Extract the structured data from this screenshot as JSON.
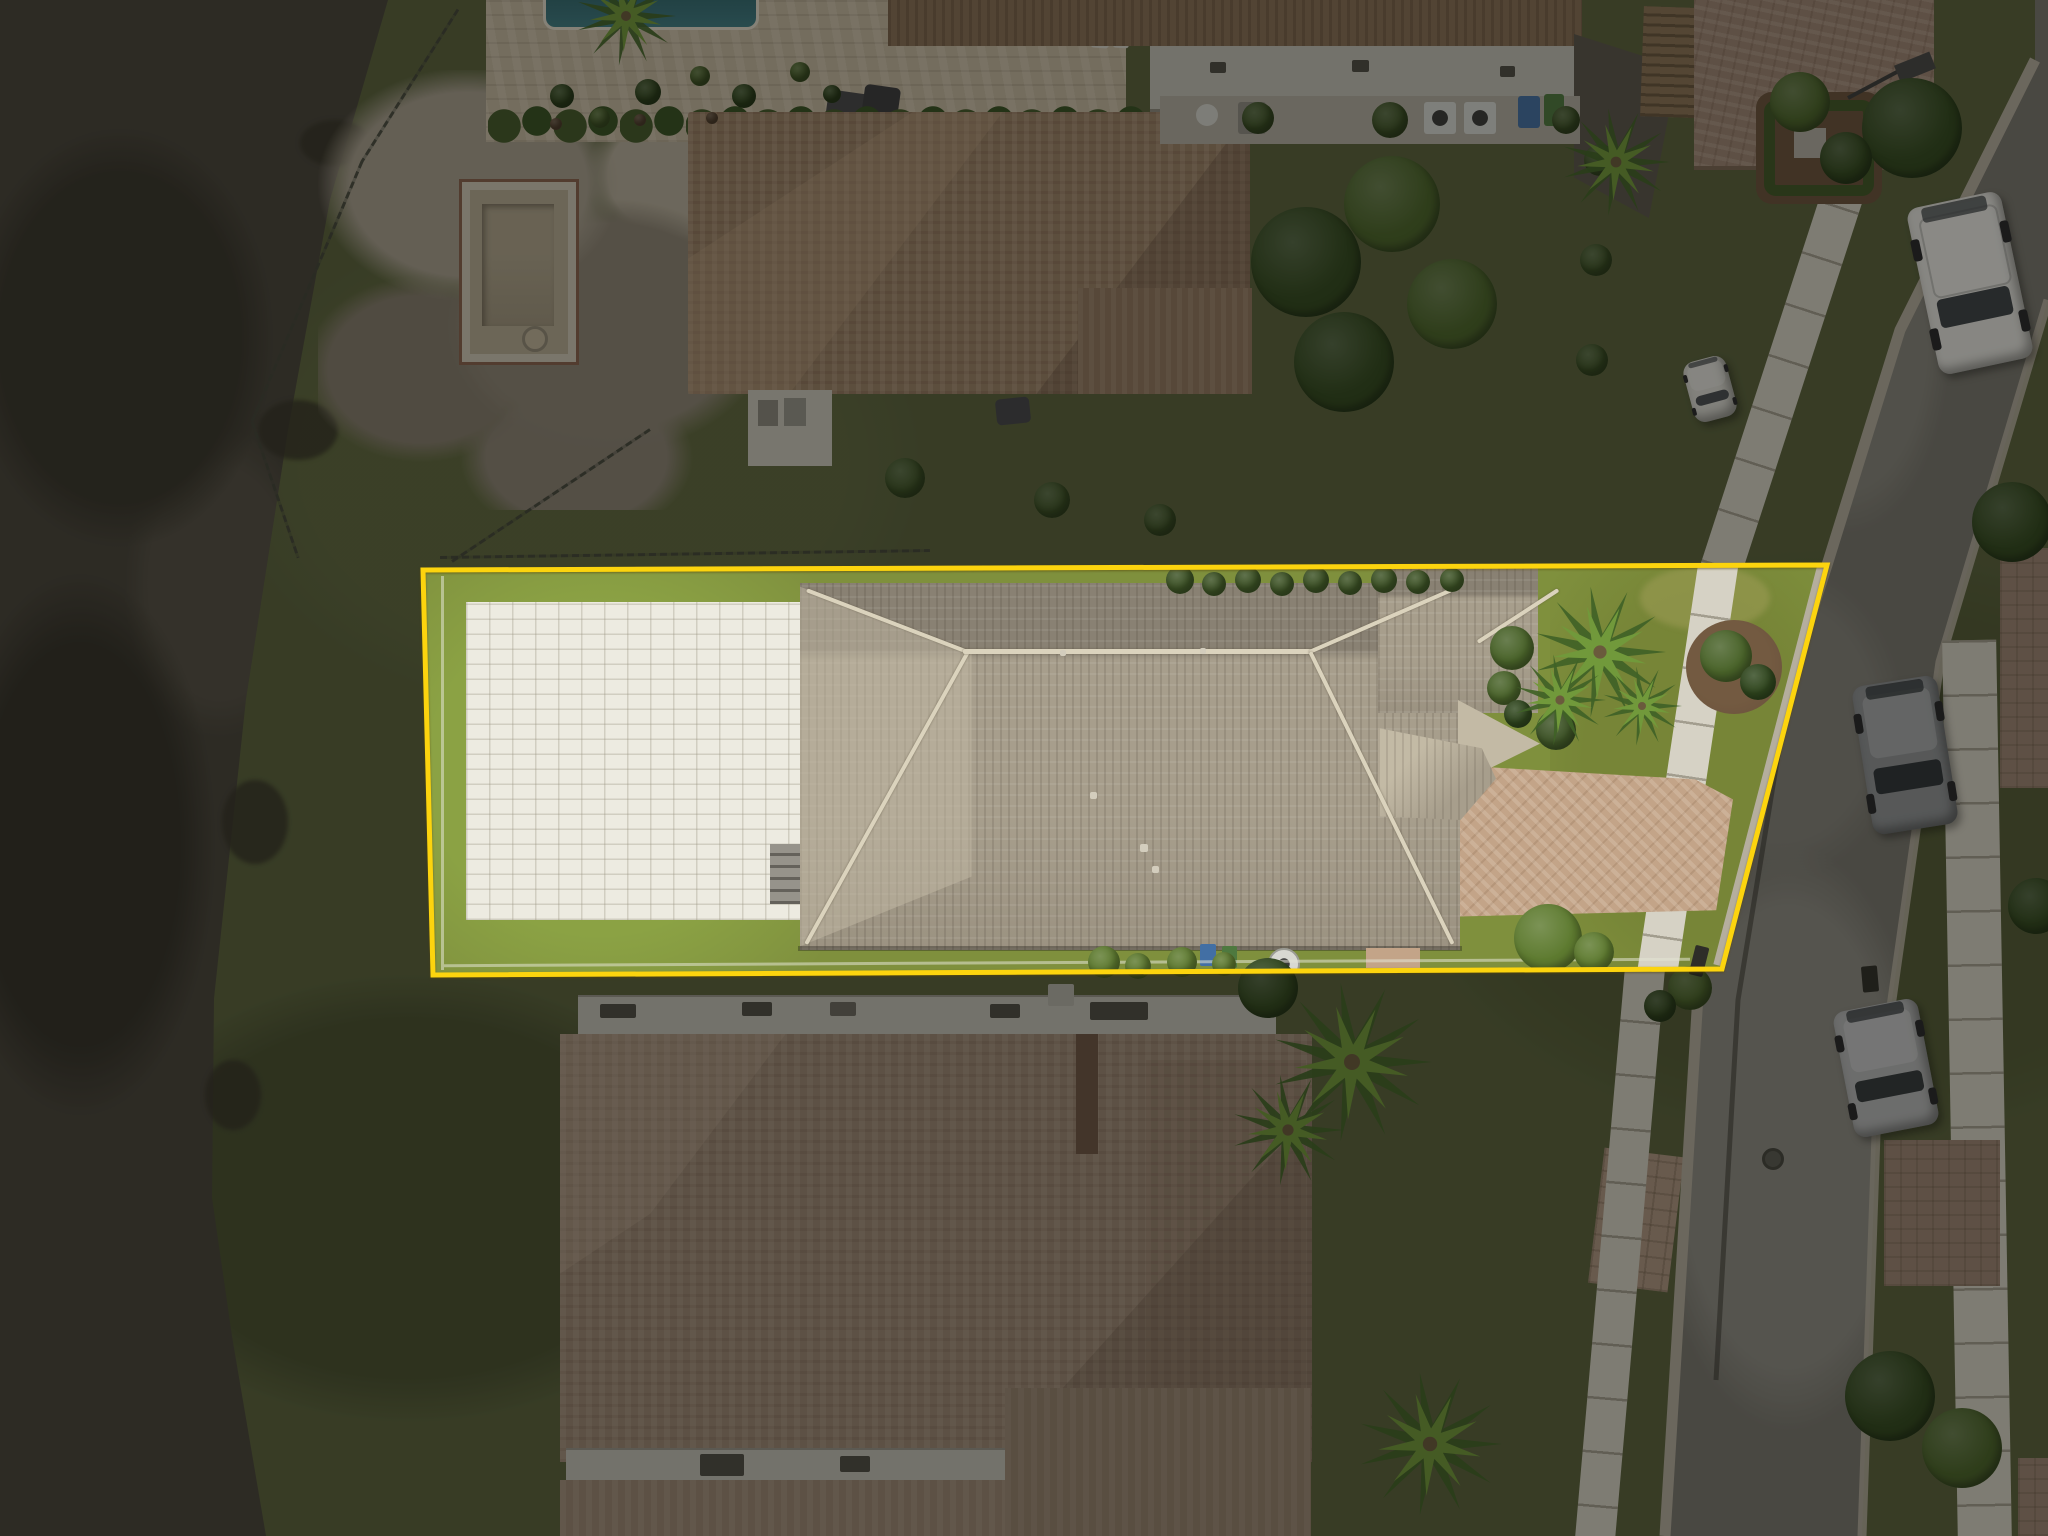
{
  "meta": {
    "title": "Aerial drone photo of residential property with highlighted lot boundary",
    "image_type": "aerial-photo",
    "width": 2048,
    "height": 1536,
    "features": [
      "lake",
      "lot-boundary-outline",
      "swimming-pool",
      "sun-shelf",
      "spa",
      "paver-pool-deck",
      "tile-roof-house",
      "solar-panel-array",
      "driveway",
      "sidewalk",
      "street",
      "parked-vehicles",
      "neighbor-houses",
      "construction-dirt-lot",
      "empty-pool-shell"
    ]
  },
  "palette": {
    "lake": "#46423a",
    "lakeDark": "#37342c",
    "bank": "#59613a",
    "grassLot": "#7e9138",
    "grassVivid": "#8aa33e",
    "dirt": "#8e8575",
    "dirtLight": "#a89f8e",
    "rubble": "#b7ae9b",
    "shellTan": "#b6ab93",
    "deck": "#edebe0",
    "ndeck": "#c6b89f",
    "pool": "#5697a9",
    "poolDeep": "#3d8298",
    "poolEdge": "#8fc2c9",
    "shelf": "#cbbc9d",
    "spa": "#4d8ba0",
    "roof": "#a89e8b",
    "roofDark": "#8a8172",
    "roofLight": "#c4baa3",
    "ridge": "#dcd3bb",
    "nroof1": "#9c8065",
    "nroof1b": "#8a6f55",
    "nroof2": "#9d8672",
    "nroof2d": "#6f5542",
    "flatRoof": "#c3c1b7",
    "pergola": "#8d7254",
    "asphalt": "#78766f",
    "asphaltL": "#8d8b84",
    "curb": "#b5ae9d",
    "walk": "#d6d2c4",
    "paverDrive": "#c5a486",
    "paverN": "#9f8573",
    "paverTan": "#b09781",
    "solar": "#26334b",
    "solarLine": "#7187a0",
    "hedge": "#3c5423",
    "tree": "#486426",
    "treeDark": "#2f481c",
    "bushBright": "#5d7c2b",
    "palmLight": "#6f9a35",
    "palmDark": "#3e6323",
    "mulch": "#6b5139",
    "fence": "#3f4236",
    "yellow": "#ffd400"
  },
  "lot": {
    "boundary_points": [
      [
        423,
        570
      ],
      [
        1827,
        565
      ],
      [
        1722,
        969
      ],
      [
        433,
        975
      ]
    ],
    "line_color": "#ffd400",
    "line_width": 5,
    "dim_fill": "rgba(14,13,9,0.44)"
  },
  "solar": {
    "panel_count": 25,
    "groups": [
      {
        "x": 1021,
        "y": 794,
        "cols": 3,
        "pw": 30,
        "ph": 50
      },
      {
        "x": 966,
        "y": 846,
        "cols": 4,
        "pw": 36,
        "ph": 44
      },
      {
        "x": 1166,
        "y": 792,
        "cols": 2,
        "pw": 29,
        "ph": 50
      },
      {
        "x": 1162,
        "y": 846,
        "cols": 3,
        "pw": 30,
        "ph": 44
      },
      {
        "x": 916,
        "y": 888,
        "cols": 4,
        "pw": 34,
        "ph": 48
      },
      {
        "x": 1078,
        "y": 888,
        "cols": 9,
        "pw": 36,
        "ph": 48
      }
    ]
  },
  "pool": {
    "path": "M 100 60 C 130 48,160 58,172 76 C 184 92,200 96,214 92 C 228 90,238 102,236 116 C 234 130,224 138,212 142 C 222 154,226 170,218 184 C 210 198,196 202,184 196 C 180 212,166 224,148 222 C 132 238,112 252,96 244 C 78 236,72 218,78 202 C 62 196,52 182,54 166 C 40 158,34 140,42 124 C 50 108,62 100,74 94 C 82 76,90 66,100 60 Z",
    "shelf": {
      "cx": 244,
      "cy": 102,
      "r": 44
    },
    "spa": {
      "cx": 227,
      "cy": 170,
      "r": 31
    },
    "lights": [
      [
        80,
        191
      ],
      [
        93,
        218
      ],
      [
        213,
        166
      ],
      [
        242,
        169
      ]
    ]
  },
  "vehicles": [
    {
      "name": "white-pickup-truck",
      "x": 1922,
      "y": 198,
      "w": 96,
      "h": 170,
      "angle": -12,
      "body": "#e6e5e1",
      "glass": "#3c4146",
      "type": "pickup"
    },
    {
      "name": "gray-suv",
      "x": 1862,
      "y": 680,
      "w": 86,
      "h": 150,
      "angle": -9,
      "body": "#909397",
      "glass": "#2e3338",
      "type": "suv"
    },
    {
      "name": "silver-suv",
      "x": 1843,
      "y": 1004,
      "w": 86,
      "h": 128,
      "angle": -11,
      "body": "#b7b8ba",
      "glass": "#33383c",
      "type": "suv"
    },
    {
      "name": "white-car-partial",
      "x": 1688,
      "y": 358,
      "w": 44,
      "h": 62,
      "angle": -15,
      "body": "#dddcd6",
      "glass": "#4a4e52",
      "type": "car"
    }
  ],
  "palms": [
    [
      1600,
      652,
      66
    ],
    [
      1560,
      700,
      46
    ],
    [
      1642,
      706,
      40
    ],
    [
      1616,
      162,
      54
    ],
    [
      1352,
      1062,
      80
    ],
    [
      1288,
      1130,
      56
    ],
    [
      1430,
      1444,
      72
    ],
    [
      626,
      16,
      50
    ]
  ],
  "bushes": [
    [
      1512,
      648,
      22,
      "tree"
    ],
    [
      1504,
      688,
      17,
      "tree"
    ],
    [
      1518,
      714,
      14,
      "treeDark"
    ],
    [
      1556,
      730,
      20,
      "hedge"
    ],
    [
      1548,
      938,
      34,
      "bushBright"
    ],
    [
      1594,
      952,
      20,
      "bushBright"
    ],
    [
      1104,
      962,
      16,
      "bushBright"
    ],
    [
      1138,
      966,
      13,
      "bushBright"
    ],
    [
      1182,
      962,
      15,
      "bushBright"
    ],
    [
      1224,
      964,
      12,
      "bushBright"
    ],
    [
      1726,
      656,
      26,
      "tree"
    ],
    [
      1758,
      682,
      18,
      "treeDark"
    ],
    [
      1180,
      580,
      14,
      "hedge"
    ],
    [
      1214,
      584,
      12,
      "hedge"
    ],
    [
      1248,
      580,
      13,
      "hedge"
    ],
    [
      1282,
      584,
      12,
      "hedge"
    ],
    [
      1316,
      580,
      13,
      "hedge"
    ],
    [
      1350,
      583,
      12,
      "hedge"
    ],
    [
      1384,
      580,
      13,
      "hedge"
    ],
    [
      1418,
      582,
      12,
      "hedge"
    ],
    [
      1452,
      580,
      12,
      "hedge"
    ],
    [
      1306,
      262,
      55,
      "treeDark"
    ],
    [
      1392,
      204,
      48,
      "tree"
    ],
    [
      1344,
      362,
      50,
      "treeDark"
    ],
    [
      1452,
      304,
      45,
      "tree"
    ],
    [
      905,
      478,
      20,
      "hedge"
    ],
    [
      1052,
      500,
      18,
      "hedge"
    ],
    [
      1160,
      520,
      16,
      "hedge"
    ],
    [
      562,
      96,
      12,
      "treeDark"
    ],
    [
      600,
      118,
      10,
      "tree"
    ],
    [
      648,
      92,
      13,
      "treeDark"
    ],
    [
      700,
      76,
      10,
      "tree"
    ],
    [
      744,
      96,
      12,
      "treeDark"
    ],
    [
      800,
      72,
      10,
      "tree"
    ],
    [
      832,
      94,
      9,
      "treeDark"
    ],
    [
      556,
      124,
      6,
      "mulch"
    ],
    [
      640,
      120,
      6,
      "mulch"
    ],
    [
      712,
      118,
      6,
      "mulch"
    ],
    [
      1390,
      120,
      18,
      "hedge"
    ],
    [
      1258,
      118,
      16,
      "hedge"
    ],
    [
      1566,
      120,
      14,
      "hedge"
    ],
    [
      1600,
      160,
      16,
      "hedge"
    ],
    [
      1596,
      260,
      16,
      "hedge"
    ],
    [
      1592,
      360,
      16,
      "hedge"
    ],
    [
      1912,
      128,
      50,
      "treeDark"
    ],
    [
      1800,
      102,
      30,
      "tree"
    ],
    [
      1846,
      158,
      26,
      "treeDark"
    ],
    [
      2012,
      522,
      40,
      "treeDark"
    ],
    [
      1890,
      1396,
      45,
      "treeDark"
    ],
    [
      1962,
      1448,
      40,
      "tree"
    ],
    [
      2036,
      906,
      28,
      "treeDark"
    ],
    [
      1268,
      988,
      30,
      "treeDark"
    ],
    [
      1690,
      988,
      22,
      "tree"
    ],
    [
      1660,
      1006,
      16,
      "treeDark"
    ]
  ],
  "fences": [
    [
      458,
      8,
      362,
      160
    ],
    [
      362,
      160,
      252,
      420
    ],
    [
      252,
      420,
      298,
      556
    ],
    [
      650,
      428,
      452,
      560
    ],
    [
      440,
      556,
      930,
      549
    ]
  ],
  "street": {
    "clip": [
      [
        435,
        0
      ],
      [
        448,
        0
      ],
      [
        448,
        300
      ],
      [
        340,
        662
      ],
      [
        277,
        1105
      ],
      [
        262,
        1536
      ],
      [
        65,
        1536
      ],
      [
        100,
        962
      ],
      [
        227,
        565
      ],
      [
        300,
        330
      ],
      [
        435,
        60
      ]
    ],
    "curb_left": [
      [
        2035,
        60
      ],
      [
        1900,
        330
      ],
      [
        1827,
        565
      ],
      [
        1700,
        962
      ],
      [
        1665,
        1536
      ]
    ],
    "curb_right": [
      [
        2048,
        300
      ],
      [
        1940,
        662
      ],
      [
        1877,
        1105
      ],
      [
        1862,
        1536
      ]
    ],
    "crack": [
      [
        1800,
        620
      ],
      [
        1738,
        1000
      ],
      [
        1716,
        1380
      ]
    ]
  },
  "drains": [
    [
      1692,
      946,
      14,
      30,
      14
    ],
    [
      1862,
      966,
      16,
      26,
      -5
    ]
  ],
  "manhole": {
    "x": 1762,
    "y": 1148,
    "d": 22
  }
}
